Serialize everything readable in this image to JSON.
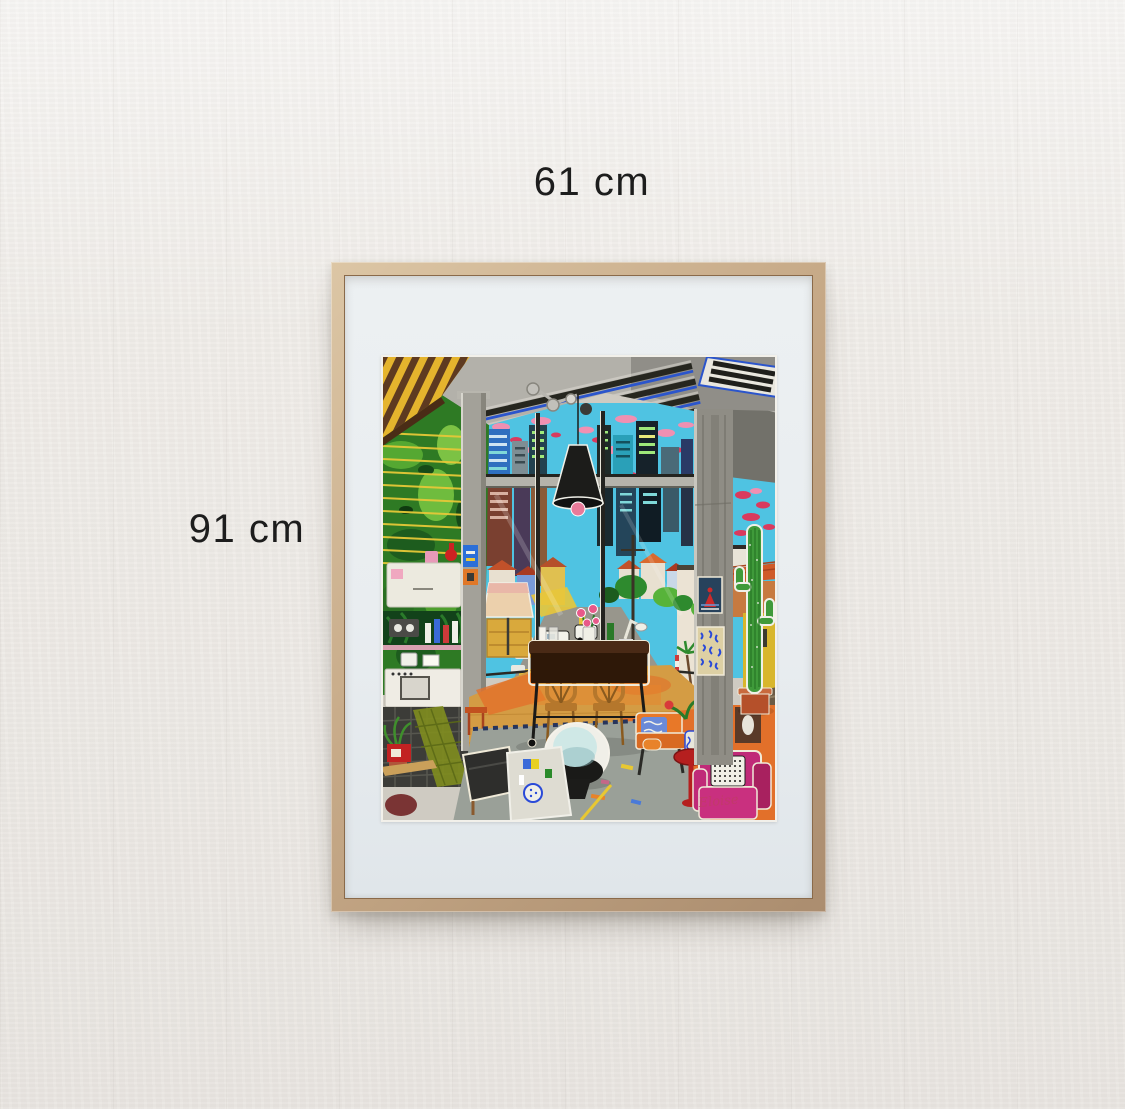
{
  "wall": {
    "color": "#f0ede9"
  },
  "dimension_labels": {
    "width": "61 cm",
    "height": "91 cm",
    "text_color": "#1d1d1d"
  },
  "frame": {
    "wood_color": "#c6a987",
    "wood_edge_color": "#8a6a4a",
    "mat_color": "#e9edf0"
  },
  "artwork": {
    "description": "Colorful naive-style painting of a loft living room with floor-to-ceiling windows overlooking a hillside city street, skyscrapers and a cyan sky full of pink and red clouds",
    "signature": "Eloise",
    "palette": {
      "sky": "#4fc3e2",
      "cloud_pink": "#f090b2",
      "cloud_red": "#d93a5e",
      "ceiling": "#b3b1aa",
      "skylight_blue": "#2b55cc",
      "awning_yellow": "#e5b42d",
      "awning_brown": "#5e3a20",
      "foliage": "#2e7a24",
      "blind_yellow": "#e6c838",
      "pillar": "#a3a199",
      "street": "#98968c",
      "road_yellow": "#e8c63a",
      "floor_wood": "#d49c44",
      "carpet_orange": "#e2702a",
      "table_brown": "#3a2010",
      "chair_wood": "#b5772c",
      "rug_gray": "#9aa098",
      "ball_chair": "#cfe8e6",
      "bench_black": "#2e2e2c",
      "sofa_orange": "#e87828",
      "side_table_red": "#b51f1f",
      "armchair_magenta": "#c02a78",
      "cactus_green": "#3f9a3a",
      "lamp_black": "#1c1c1a",
      "lamp_pink": "#e87a9a",
      "signature_pink": "#c23a6a"
    }
  }
}
